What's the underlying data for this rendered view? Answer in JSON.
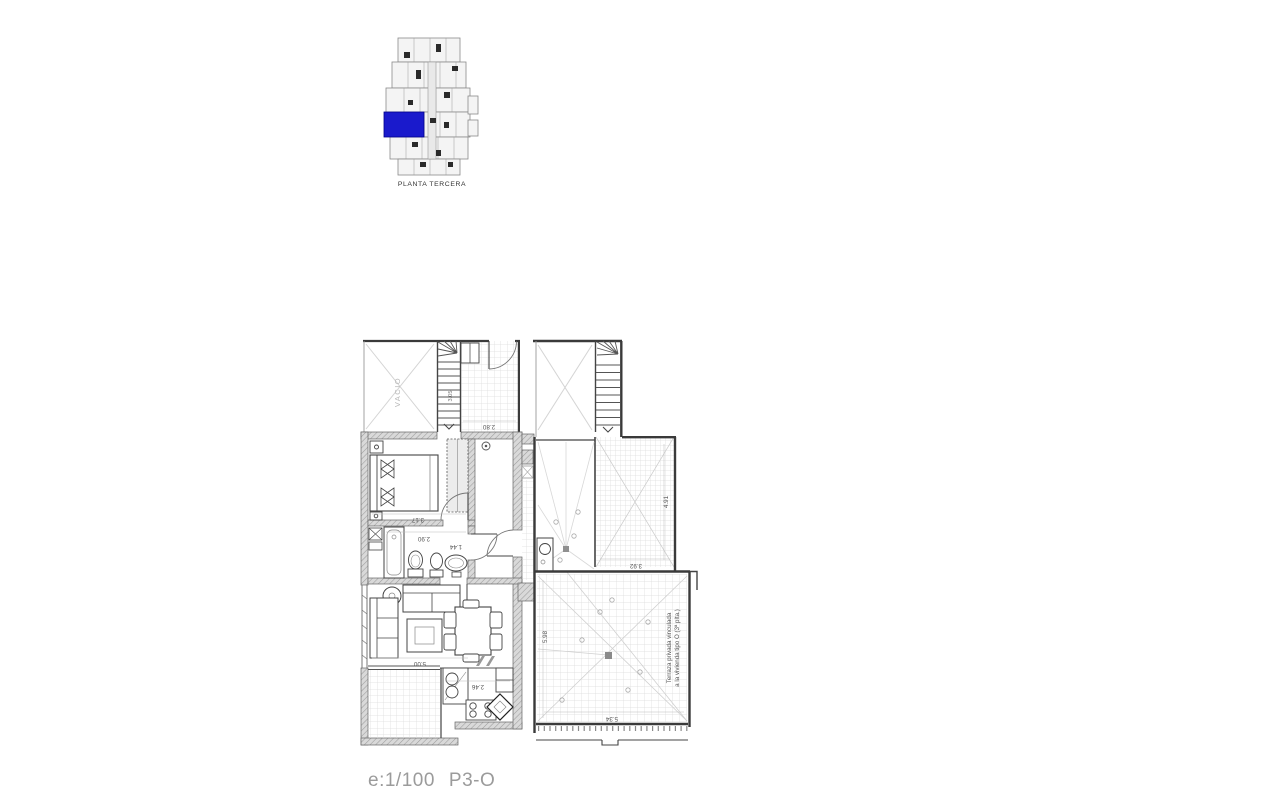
{
  "key_plan": {
    "label": "PLANTA TERCERA",
    "highlight_color": "#1a1acc"
  },
  "floor_plan": {
    "void_label": "VACIO",
    "stair_dim": "3.05",
    "dims": {
      "landing": "2.80",
      "bedroom": "3.17",
      "bathroom": "2.90",
      "hall": "1.44",
      "living": "5.00",
      "kitchen": "2.46",
      "terrace_right": "4.91",
      "terrace_upper": "3.92",
      "terrace_bottom": "5.34",
      "terrace_left": "5.98"
    },
    "terrace_note": {
      "line1": "Terraza privada vinculada",
      "line2": "a la vivienda tipo O (3ª plta.)"
    }
  },
  "footer": {
    "scale": "e:1/100",
    "code": "P3-O"
  }
}
